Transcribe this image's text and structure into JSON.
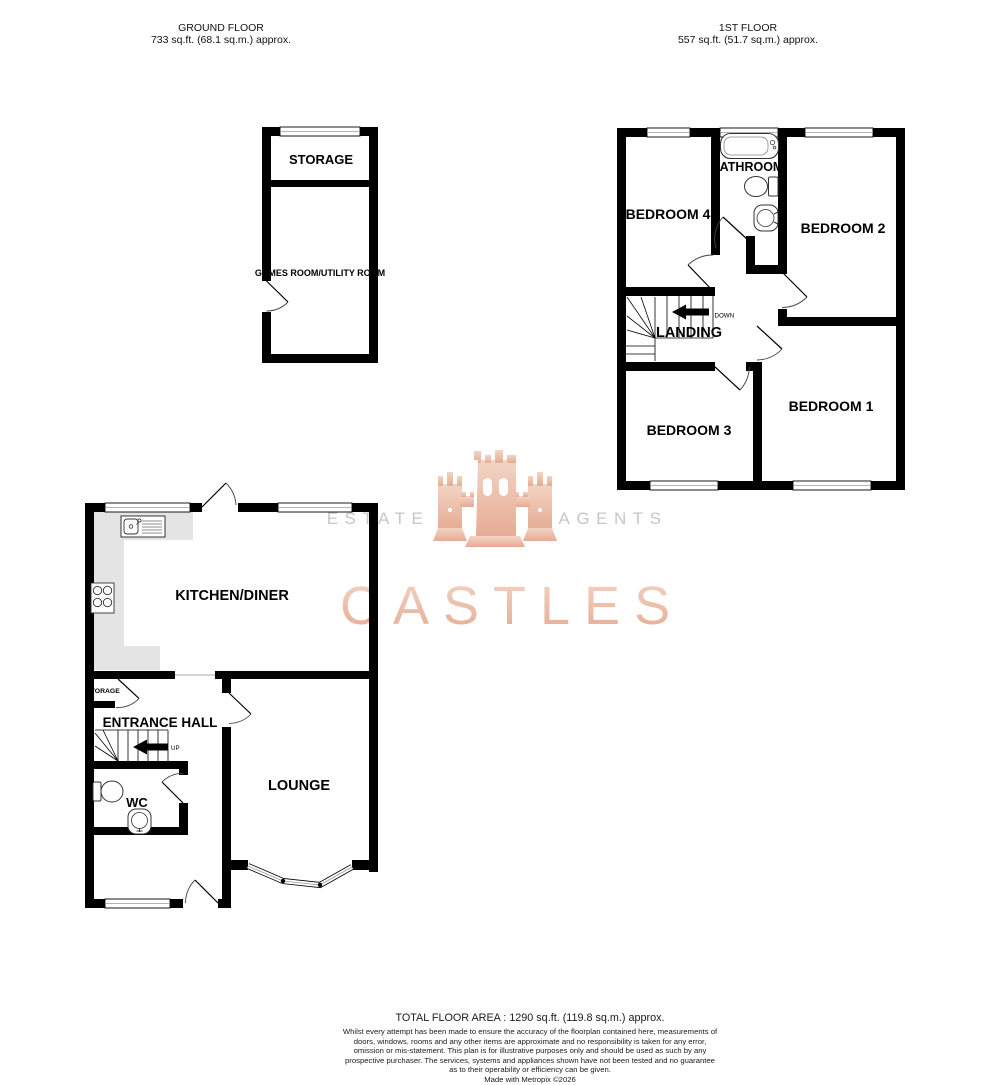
{
  "headers": {
    "ground_floor": {
      "title": "GROUND FLOOR",
      "area": "733 sq.ft. (68.1 sq.m.) approx."
    },
    "first_floor": {
      "title": "1ST FLOOR",
      "area": "557 sq.ft. (51.7 sq.m.) approx."
    }
  },
  "rooms": {
    "storage_outbuilding": "STORAGE",
    "games_room": "GAMES ROOM/UTILITY ROOM",
    "bedroom_4": "BEDROOM 4",
    "bathroom": "BATHROOM",
    "bedroom_2": "BEDROOM 2",
    "landing": "LANDING",
    "bedroom_3": "BEDROOM 3",
    "bedroom_1": "BEDROOM 1",
    "kitchen_diner": "KITCHEN/DINER",
    "hall_storage": "STORAGE",
    "entrance_hall": "ENTRANCE HALL",
    "wc": "WC",
    "lounge": "LOUNGE"
  },
  "stairs": {
    "up_label": "UP",
    "down_label": "DOWN"
  },
  "watermark": {
    "left": "ESTATE",
    "right": "AGENTS",
    "brand": "CASTLES"
  },
  "footer": {
    "total_area": "TOTAL FLOOR AREA : 1290 sq.ft. (119.8 sq.m.) approx.",
    "disclaimer": "Whilst every attempt has been made to ensure the accuracy of the floorplan contained here, measurements of doors, windows, rooms and any other items are approximate and no responsibility is taken for any error, omission or mis-statement. This plan is for illustrative purposes only and should be used as such by any prospective purchaser. The services, systems and appliances shown have not been tested and no guarantee as to their operability or efficiency can be given.",
    "credit": "Made with Metropix ©2026"
  },
  "colors": {
    "wall": "#000000",
    "counter": "#e4e4e4",
    "watermark_peach": "#ecc3b1",
    "watermark_gray": "#c6c6c6"
  }
}
